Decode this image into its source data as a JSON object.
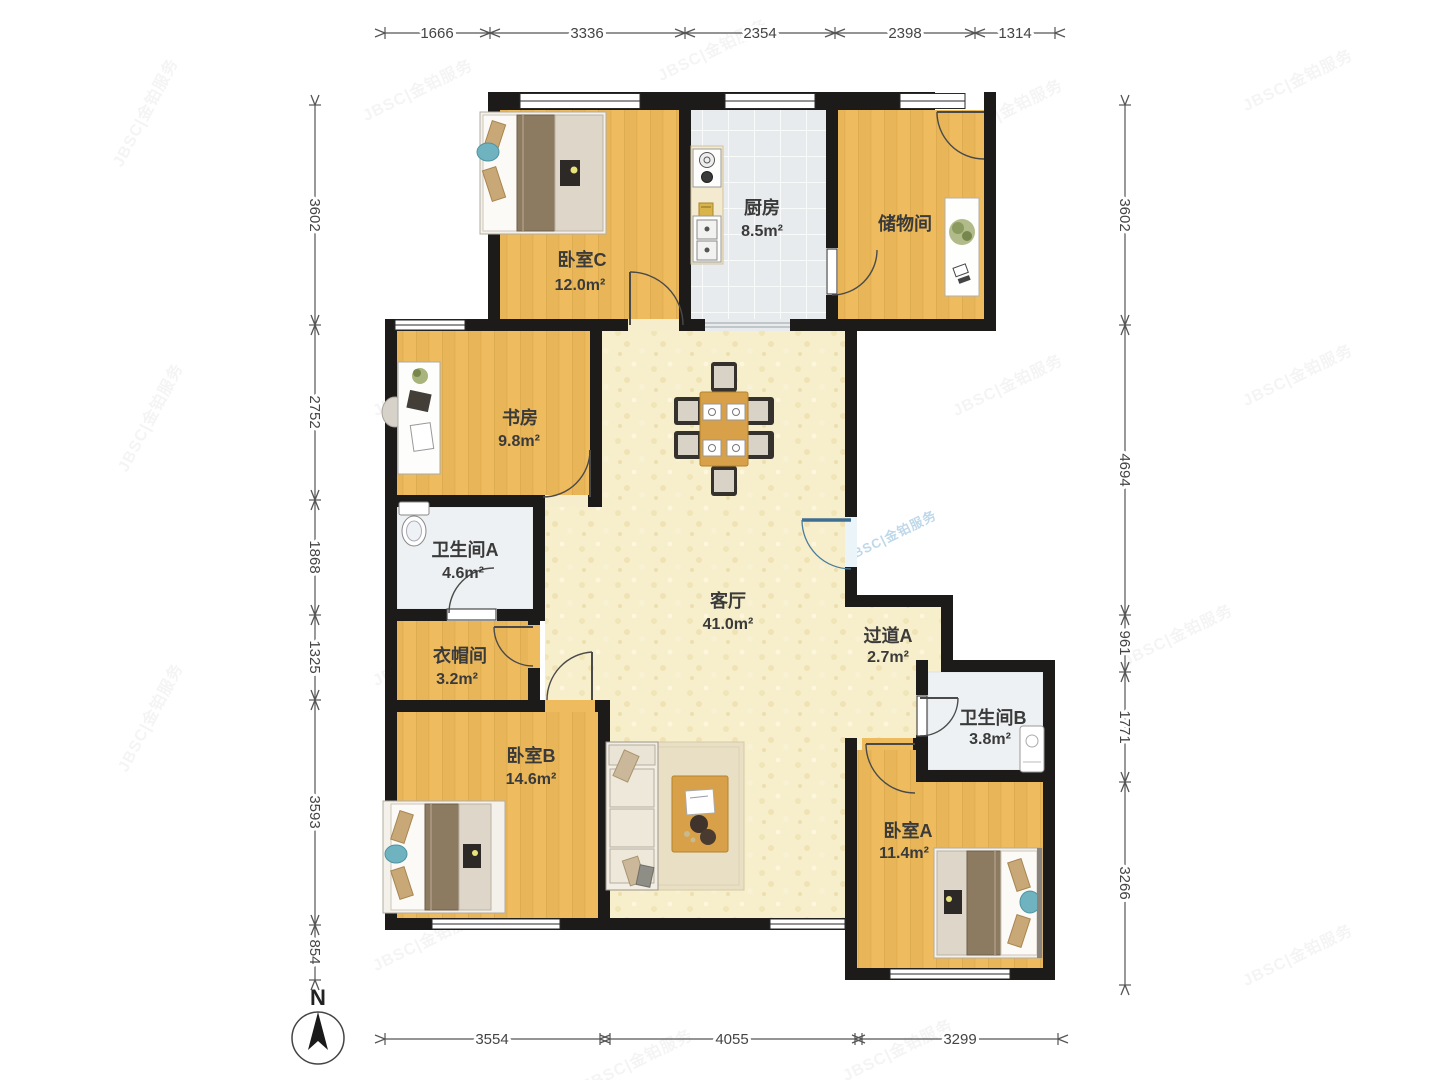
{
  "watermark": {
    "text": "JBSC|金铂服务"
  },
  "compass": {
    "north_label": "N"
  },
  "dimensions": {
    "top": [
      "1666",
      "3336",
      "2354",
      "2398",
      "1314"
    ],
    "left": [
      "3602",
      "2752",
      "1868",
      "1325",
      "3593",
      "854"
    ],
    "right": [
      "3602",
      "4694",
      "961",
      "1771",
      "3266"
    ],
    "bottom": [
      "3554",
      "4055",
      "3299"
    ]
  },
  "rooms": {
    "bedroom_c": {
      "name": "卧室C",
      "area": "12.0m²"
    },
    "kitchen": {
      "name": "厨房",
      "area": "8.5m²"
    },
    "storage": {
      "name": "储物间"
    },
    "study": {
      "name": "书房",
      "area": "9.8m²"
    },
    "bathroom_a": {
      "name": "卫生间A",
      "area": "4.6m²"
    },
    "cloakroom": {
      "name": "衣帽间",
      "area": "3.2m²"
    },
    "living_room": {
      "name": "客厅",
      "area": "41.0m²"
    },
    "hallway_a": {
      "name": "过道A",
      "area": "2.7m²"
    },
    "bathroom_b": {
      "name": "卫生间B",
      "area": "3.8m²"
    },
    "bedroom_b": {
      "name": "卧室B",
      "area": "14.6m²"
    },
    "bedroom_a": {
      "name": "卧室A",
      "area": "11.4m²"
    }
  },
  "colors": {
    "wall": "#1c1b19",
    "wood_floor": "#eebc5f",
    "tile_floor": "#e8ebed",
    "living_floor": "#f7eecb",
    "entrance_door": "#3f6e93",
    "accent_pillow": "#6fb3c0"
  }
}
